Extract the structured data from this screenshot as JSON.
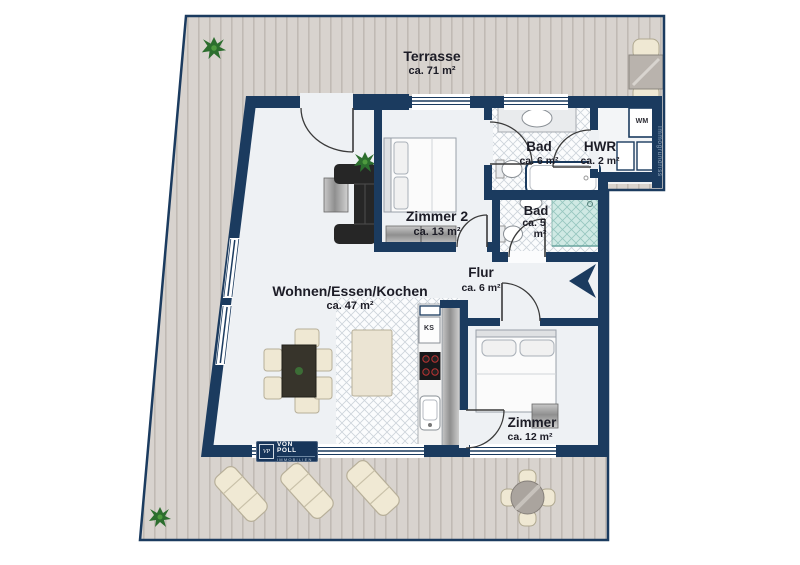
{
  "rooms": {
    "terrasse": {
      "name": "Terrasse",
      "area": "ca. 71 m²"
    },
    "bad1": {
      "name": "Bad",
      "area": "ca. 6 m²"
    },
    "hwr": {
      "name": "HWR",
      "area": "ca. 2 m²"
    },
    "zimmer2": {
      "name": "Zimmer 2",
      "area": "ca. 13 m²"
    },
    "bad2": {
      "name": "Bad",
      "area_top": "ca. 5",
      "area_bottom": "m²"
    },
    "flur": {
      "name": "Flur",
      "area": "ca. 6 m²"
    },
    "wohnen": {
      "name": "Wohnen/Essen/Kochen",
      "area": "ca. 47 m²"
    },
    "zimmer": {
      "name": "Zimmer",
      "area": "ca. 12 m²"
    }
  },
  "appliances": {
    "washing_machine": "WM",
    "fridge": "KS"
  },
  "logo": {
    "monogram": "VP",
    "brand": "VON POLL",
    "division": "IMMOBILIEN"
  },
  "watermark": "Immogrundriss",
  "colors": {
    "wall_navy": "#1b3b5f",
    "terrace_plank": "#d8d3ce",
    "interior_floor": "#eef1f4",
    "tile_line": "#ccd3da",
    "shower_teal": "#cfe9e4",
    "furniture_cream": "#efe8d3",
    "furniture_dark": "#262626"
  }
}
